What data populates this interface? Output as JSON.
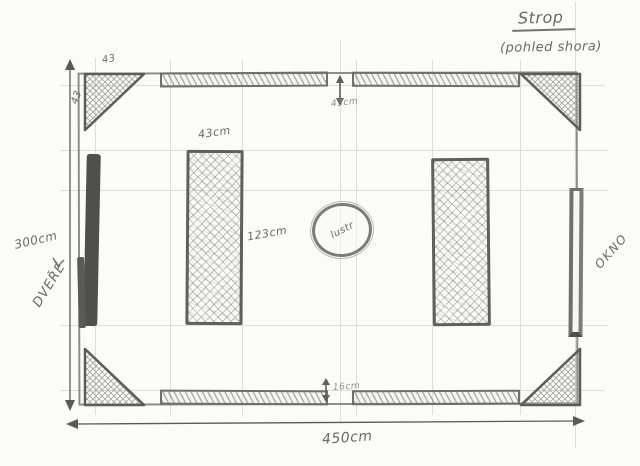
{
  "title": {
    "main": "Strop",
    "subtitle": "(pohled shora)"
  },
  "room": {
    "width_label": "450cm",
    "height_label": "300cm",
    "door_label": "DVEŘE",
    "window_label": "OKNO",
    "light_label": "lustr"
  },
  "corner_panels": {
    "top_label": "43",
    "side_label": "43"
  },
  "beams": {
    "top_gap_label": "43cm",
    "bottom_gap_label": "16cm"
  },
  "columns": {
    "width_label": "43cm",
    "height_label": "123cm"
  },
  "icons": {
    "up_arrow": "↑",
    "down_arrow": "↓",
    "left_arrow": "←",
    "right_arrow": "→",
    "double_arrow_vertical": "↕",
    "door_pointer": "˅"
  },
  "colors": {
    "pencil": "#6b6b68",
    "pencil_dark": "#4e4e4c",
    "pencil_faint": "#dddcd6",
    "paper": "#fbfbf8"
  }
}
